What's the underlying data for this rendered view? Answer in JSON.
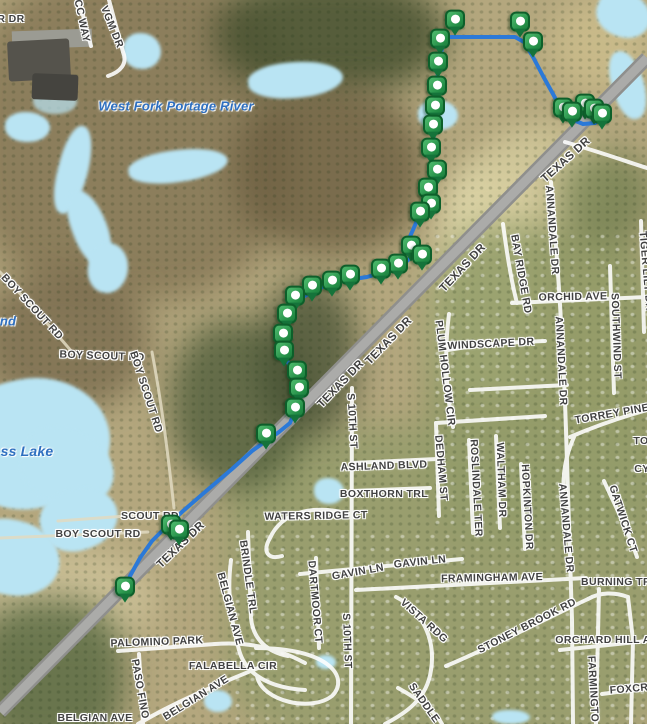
{
  "map": {
    "colors": {
      "route": "#2b79d8",
      "marker_green": "#259048",
      "water": "#b9e4f3",
      "road_gray": "#8f8f8d",
      "street_white": "#ffffff",
      "street_label": "#414141",
      "water_label": "#2e6fc0"
    },
    "route": {
      "points": [
        [
          126,
          594
        ],
        [
          130,
          576
        ],
        [
          140,
          558
        ],
        [
          152,
          541
        ],
        [
          168,
          525
        ],
        [
          183,
          511
        ],
        [
          205,
          492
        ],
        [
          232,
          469
        ],
        [
          252,
          451
        ],
        [
          266,
          441
        ],
        [
          279,
          432
        ],
        [
          290,
          423
        ],
        [
          296,
          409
        ],
        [
          300,
          393
        ],
        [
          297,
          379
        ],
        [
          290,
          367
        ],
        [
          284,
          353
        ],
        [
          283,
          337
        ],
        [
          286,
          321
        ],
        [
          293,
          308
        ],
        [
          303,
          297
        ],
        [
          315,
          290
        ],
        [
          330,
          284
        ],
        [
          347,
          280
        ],
        [
          367,
          277
        ],
        [
          387,
          271
        ],
        [
          403,
          265
        ],
        [
          413,
          255
        ],
        [
          408,
          241
        ],
        [
          416,
          223
        ],
        [
          429,
          211
        ],
        [
          425,
          196
        ],
        [
          435,
          181
        ],
        [
          431,
          163
        ],
        [
          434,
          142
        ],
        [
          432,
          120
        ],
        [
          436,
          96
        ],
        [
          438,
          72
        ],
        [
          442,
          48
        ],
        [
          444,
          37
        ],
        [
          515,
          37
        ],
        [
          524,
          42
        ],
        [
          533,
          57
        ],
        [
          543,
          76
        ],
        [
          553,
          94
        ],
        [
          561,
          109
        ],
        [
          571,
          119
        ],
        [
          583,
          124
        ],
        [
          595,
          123
        ],
        [
          603,
          118
        ]
      ]
    },
    "waypoints": [
      [
        455,
        22
      ],
      [
        440,
        41
      ],
      [
        520,
        24
      ],
      [
        533,
        44
      ],
      [
        563,
        110
      ],
      [
        572,
        114
      ],
      [
        585,
        106
      ],
      [
        594,
        111
      ],
      [
        602,
        116
      ],
      [
        438,
        64
      ],
      [
        437,
        88
      ],
      [
        435,
        108
      ],
      [
        433,
        127
      ],
      [
        431,
        150
      ],
      [
        437,
        172
      ],
      [
        428,
        190
      ],
      [
        431,
        206
      ],
      [
        420,
        214
      ],
      [
        411,
        248
      ],
      [
        422,
        257
      ],
      [
        398,
        266
      ],
      [
        381,
        271
      ],
      [
        350,
        277
      ],
      [
        332,
        283
      ],
      [
        312,
        288
      ],
      [
        295,
        298
      ],
      [
        287,
        316
      ],
      [
        283,
        336
      ],
      [
        284,
        353
      ],
      [
        297,
        373
      ],
      [
        299,
        390
      ],
      [
        295,
        410
      ],
      [
        266,
        436
      ],
      [
        171,
        527
      ],
      [
        179,
        532
      ],
      [
        125,
        589
      ]
    ],
    "labels": [
      {
        "t": "R DR",
        "x": 11,
        "y": 19,
        "r": 0,
        "k": "street"
      },
      {
        "t": "CC WAY",
        "x": 82,
        "y": 21,
        "r": 78,
        "k": "street"
      },
      {
        "t": "VGM DR",
        "x": 112,
        "y": 27,
        "r": 68,
        "k": "street"
      },
      {
        "t": "West Fork Portage River",
        "x": 176,
        "y": 106,
        "r": 0,
        "k": "water"
      },
      {
        "t": "BOY SCOUT RD",
        "x": 32,
        "y": 307,
        "r": 47,
        "k": "street"
      },
      {
        "t": "nd",
        "x": 8,
        "y": 321,
        "r": 0,
        "k": "water"
      },
      {
        "t": "BOY SCOUT RD",
        "x": 102,
        "y": 356,
        "r": 2,
        "k": "street"
      },
      {
        "t": "BOY SCOUT RD",
        "x": 146,
        "y": 392,
        "r": 72,
        "k": "street"
      },
      {
        "t": "ss Lake",
        "x": 27,
        "y": 451,
        "r": 0,
        "k": "water",
        "s": 14
      },
      {
        "t": "SCOUT RD",
        "x": 150,
        "y": 516,
        "r": 0,
        "k": "street"
      },
      {
        "t": "BOY SCOUT RD",
        "x": 98,
        "y": 534,
        "r": 0,
        "k": "street"
      },
      {
        "t": "TEXAS DR",
        "x": 181,
        "y": 545,
        "r": -44,
        "k": "street",
        "s": 11.5
      },
      {
        "t": "TEXAS DR",
        "x": 341,
        "y": 384,
        "r": -46,
        "k": "street",
        "s": 11.5
      },
      {
        "t": "TEXAS DR",
        "x": 389,
        "y": 341,
        "r": -46,
        "k": "street",
        "s": 11.5
      },
      {
        "t": "TEXAS DR",
        "x": 463,
        "y": 268,
        "r": -47,
        "k": "street",
        "s": 11.5
      },
      {
        "t": "TEXAS DR",
        "x": 566,
        "y": 160,
        "r": -42,
        "k": "street",
        "s": 11.5
      },
      {
        "t": "S 10TH ST",
        "x": 352,
        "y": 421,
        "r": 87,
        "k": "street"
      },
      {
        "t": "S 10TH ST",
        "x": 347,
        "y": 641,
        "r": 88,
        "k": "street"
      },
      {
        "t": "ASHLAND BLVD",
        "x": 384,
        "y": 466,
        "r": -2,
        "k": "street"
      },
      {
        "t": "BOXTHORN TRL",
        "x": 384,
        "y": 494,
        "r": 0,
        "k": "street"
      },
      {
        "t": "WATERS RIDGE CT",
        "x": 316,
        "y": 516,
        "r": -1,
        "k": "street"
      },
      {
        "t": "DEDHAM ST",
        "x": 441,
        "y": 468,
        "r": 85,
        "k": "street"
      },
      {
        "t": "PLUM HOLLOW CIR",
        "x": 445,
        "y": 373,
        "r": 83,
        "k": "street"
      },
      {
        "t": "WINDSCAPE DR",
        "x": 491,
        "y": 344,
        "r": -3,
        "k": "street"
      },
      {
        "t": "ORCHID AVE",
        "x": 573,
        "y": 297,
        "r": -1,
        "k": "street"
      },
      {
        "t": "BAY RIDGE RD",
        "x": 521,
        "y": 274,
        "r": 80,
        "k": "street"
      },
      {
        "t": "ANNANDALE DR",
        "x": 552,
        "y": 230,
        "r": 86,
        "k": "street"
      },
      {
        "t": "ANNANDALE DR",
        "x": 561,
        "y": 361,
        "r": 87,
        "k": "street"
      },
      {
        "t": "ANNANDALE DR",
        "x": 566,
        "y": 528,
        "r": 85,
        "k": "street"
      },
      {
        "t": "SOUTHWIND ST",
        "x": 616,
        "y": 336,
        "r": 88,
        "k": "street"
      },
      {
        "t": "TIGER LILY DR",
        "x": 646,
        "y": 271,
        "r": 85,
        "k": "street"
      },
      {
        "t": "TORREY PINE",
        "x": 612,
        "y": 414,
        "r": -10,
        "k": "street"
      },
      {
        "t": "TO",
        "x": 641,
        "y": 441,
        "r": 0,
        "k": "street"
      },
      {
        "t": "CY",
        "x": 642,
        "y": 469,
        "r": 0,
        "k": "street"
      },
      {
        "t": "GATWICK CT",
        "x": 623,
        "y": 519,
        "r": 72,
        "k": "street"
      },
      {
        "t": "WALTHAM DR",
        "x": 501,
        "y": 480,
        "r": 88,
        "k": "street"
      },
      {
        "t": "ROSLINDALE TER",
        "x": 476,
        "y": 488,
        "r": 87,
        "k": "street"
      },
      {
        "t": "HOPKINTON DR",
        "x": 527,
        "y": 507,
        "r": 87,
        "k": "street"
      },
      {
        "t": "GAVIN LN",
        "x": 358,
        "y": 572,
        "r": -10,
        "k": "street"
      },
      {
        "t": "GAVIN LN",
        "x": 420,
        "y": 562,
        "r": -6,
        "k": "street"
      },
      {
        "t": "FRAMINGHAM AVE",
        "x": 492,
        "y": 578,
        "r": -1,
        "k": "street"
      },
      {
        "t": "BURNING TR",
        "x": 616,
        "y": 582,
        "r": 0,
        "k": "street"
      },
      {
        "t": "VISTA RDG",
        "x": 424,
        "y": 621,
        "r": 42,
        "k": "street"
      },
      {
        "t": "STONEY BROOK RD",
        "x": 527,
        "y": 626,
        "r": -27,
        "k": "street"
      },
      {
        "t": "ORCHARD HILL A",
        "x": 603,
        "y": 640,
        "r": 0,
        "k": "street"
      },
      {
        "t": "FARMINGTO",
        "x": 593,
        "y": 689,
        "r": 87,
        "k": "street"
      },
      {
        "t": "FOXCR",
        "x": 629,
        "y": 689,
        "r": -5,
        "k": "street"
      },
      {
        "t": "SADDLE",
        "x": 424,
        "y": 703,
        "r": 55,
        "k": "street"
      },
      {
        "t": "DARTMOOR CT",
        "x": 315,
        "y": 602,
        "r": 85,
        "k": "street"
      },
      {
        "t": "BRINDLE TRL",
        "x": 248,
        "y": 577,
        "r": 82,
        "k": "street"
      },
      {
        "t": "BELGIAN AVE",
        "x": 230,
        "y": 609,
        "r": 75,
        "k": "street"
      },
      {
        "t": "BELGIAN AVE",
        "x": 196,
        "y": 698,
        "r": -32,
        "k": "street"
      },
      {
        "t": "BELGIAN AVE",
        "x": 95,
        "y": 718,
        "r": 0,
        "k": "street"
      },
      {
        "t": "PASO FINO",
        "x": 140,
        "y": 689,
        "r": 80,
        "k": "street"
      },
      {
        "t": "PALOMINO PARK",
        "x": 157,
        "y": 642,
        "r": -2,
        "k": "street"
      },
      {
        "t": "FALABELLA CIR",
        "x": 233,
        "y": 666,
        "r": 0,
        "k": "street"
      }
    ]
  }
}
